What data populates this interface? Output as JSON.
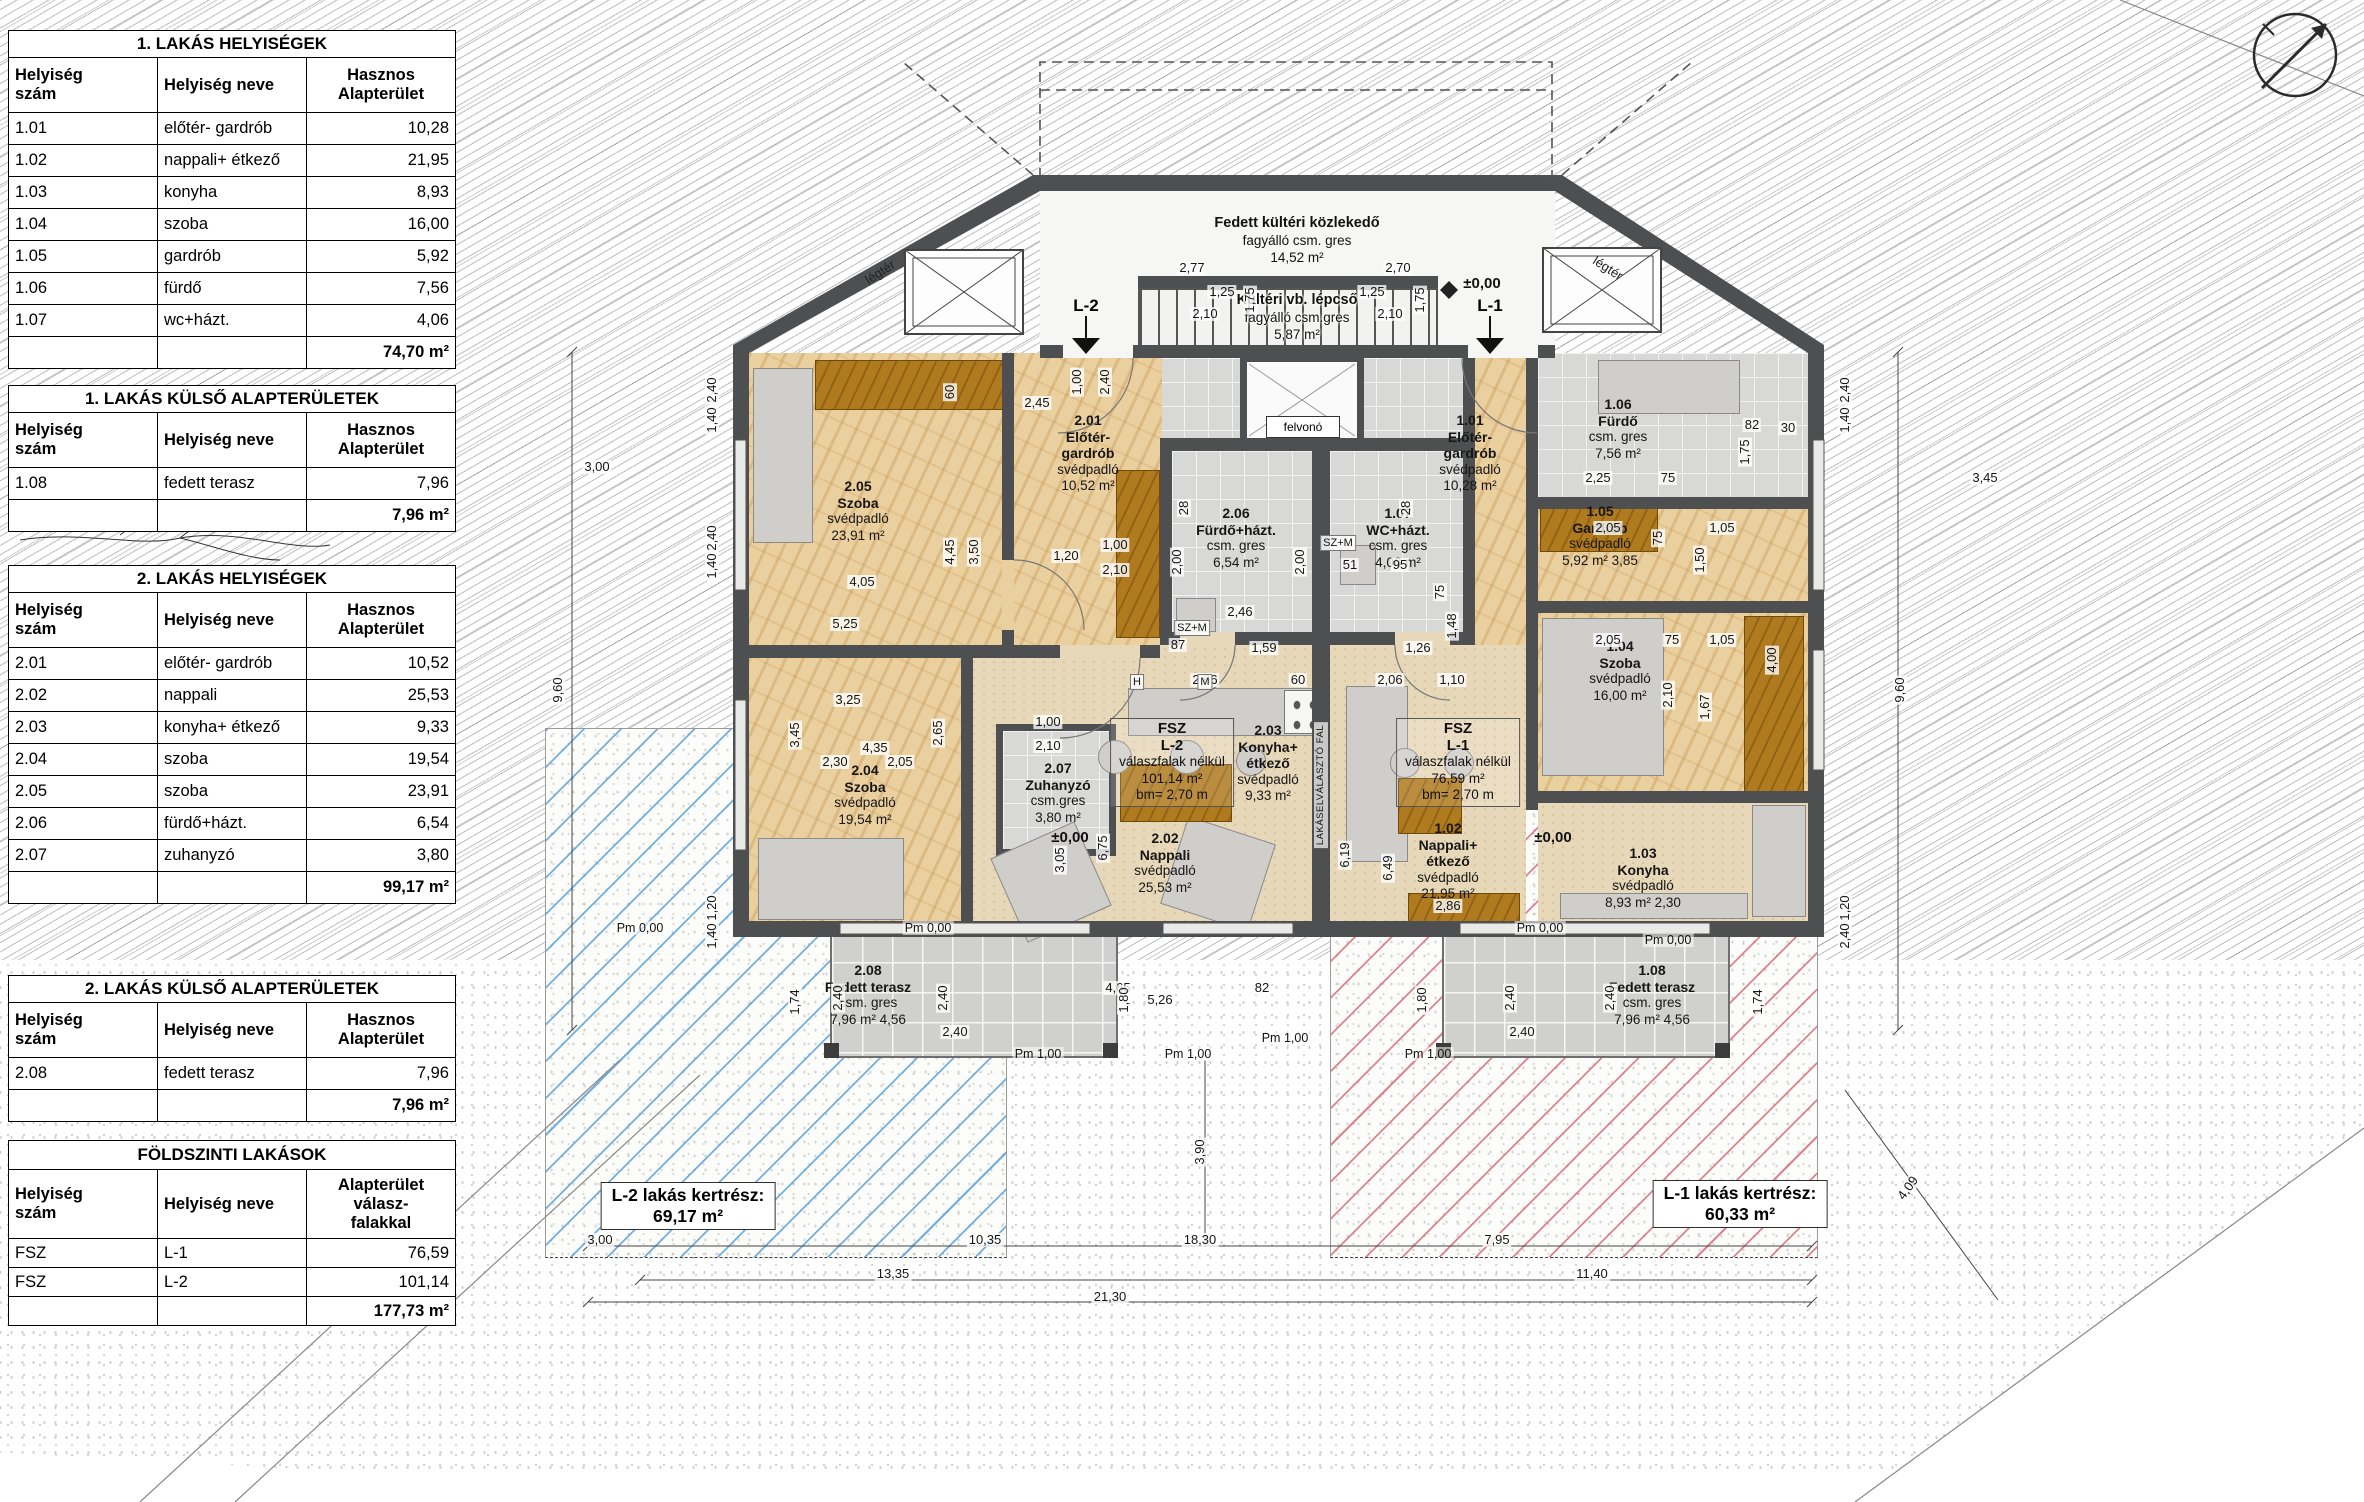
{
  "tables": [
    {
      "title": "1. LAKÁS HELYISÉGEK",
      "headers": [
        "Helyiség\nszám",
        "Helyiség neve",
        "Hasznos\nAlapterület"
      ],
      "rows": [
        [
          "1.01",
          "előtér- gardrób",
          "10,28"
        ],
        [
          "1.02",
          "nappali+ étkező",
          "21,95"
        ],
        [
          "1.03",
          "konyha",
          "8,93"
        ],
        [
          "1.04",
          "szoba",
          "16,00"
        ],
        [
          "1.05",
          "gardrób",
          "5,92"
        ],
        [
          "1.06",
          "fürdő",
          "7,56"
        ],
        [
          "1.07",
          "wc+házt.",
          "4,06"
        ]
      ],
      "total": "74,70 m²"
    },
    {
      "title": "1. LAKÁS KÜLSŐ ALAPTERÜLETEK",
      "headers": [
        "Helyiség\nszám",
        "Helyiség neve",
        "Hasznos\nAlapterület"
      ],
      "rows": [
        [
          "1.08",
          "fedett terasz",
          "7,96"
        ]
      ],
      "total": "7,96 m²"
    },
    {
      "title": "2. LAKÁS HELYISÉGEK",
      "headers": [
        "Helyiség\nszám",
        "Helyiség neve",
        "Hasznos\nAlapterület"
      ],
      "rows": [
        [
          "2.01",
          "előtér- gardrób",
          "10,52"
        ],
        [
          "2.02",
          "nappali",
          "25,53"
        ],
        [
          "2.03",
          "konyha+ étkező",
          "9,33"
        ],
        [
          "2.04",
          "szoba",
          "19,54"
        ],
        [
          "2.05",
          "szoba",
          "23,91"
        ],
        [
          "2.06",
          "fürdő+házt.",
          "6,54"
        ],
        [
          "2.07",
          "zuhanyzó",
          "3,80"
        ]
      ],
      "total": "99,17 m²"
    },
    {
      "title": "2. LAKÁS KÜLSŐ ALAPTERÜLETEK",
      "headers": [
        "Helyiség\nszám",
        "Helyiség neve",
        "Hasznos\nAlapterület"
      ],
      "rows": [
        [
          "2.08",
          "fedett terasz",
          "7,96"
        ]
      ],
      "total": "7,96 m²"
    },
    {
      "title": "FÖLDSZINTI LAKÁSOK",
      "headers": [
        "Helyiség\nszám",
        "Helyiség neve",
        "Alapterület\nválasz-\nfalakkal"
      ],
      "rows": [
        [
          "FSZ",
          "L-1",
          "76,59"
        ],
        [
          "FSZ",
          "L-2",
          "101,14"
        ]
      ],
      "total": "177,73 m²"
    }
  ],
  "plan": {
    "entrance": {
      "l1": "Fedett kültéri közlekedő",
      "l2": "fagyálló csm. gres",
      "l3": "14,52 m²"
    },
    "stair": {
      "l1": "Kültéri vb. lépcső",
      "l2": "fagyálló csm.gres",
      "l3": "5,87 m²"
    },
    "elevator": "felvonó",
    "legter": "légtér",
    "markers": [
      "L-2",
      "L-1"
    ],
    "rooms": [
      {
        "id": "2.05",
        "name": "Szoba",
        "floor": "svédpadló",
        "area": "23,91 m²",
        "cx": 858,
        "ty": 478
      },
      {
        "id": "2.01",
        "name": "Előtér-\ngardrób",
        "floor": "svédpadló",
        "area": "10,52 m²",
        "cx": 1088,
        "ty": 412
      },
      {
        "id": "2.06",
        "name": "Fürdő+házt.",
        "floor": "csm. gres",
        "area": "6,54 m²",
        "cx": 1236,
        "ty": 505
      },
      {
        "id": "1.07",
        "name": "WC+házt.",
        "floor": "csm. gres",
        "area": "4,06 m²",
        "cx": 1398,
        "ty": 505
      },
      {
        "id": "2.04",
        "name": "Szoba",
        "floor": "svédpadló",
        "area": "19,54 m²",
        "cx": 865,
        "ty": 762
      },
      {
        "id": "2.07",
        "name": "Zuhanyzó",
        "floor": "csm.gres",
        "area": "3,80 m²",
        "cx": 1058,
        "ty": 760
      },
      {
        "id": "2.03",
        "name": "Konyha+\nétkező",
        "floor": "svédpadló",
        "area": "9,33 m²",
        "cx": 1268,
        "ty": 722
      },
      {
        "id": "2.02",
        "name": "Nappali",
        "floor": "svédpadló",
        "area": "25,53 m²",
        "cx": 1165,
        "ty": 830
      },
      {
        "id": "2.08",
        "name": "Fedett terasz",
        "floor": "csm. gres",
        "area": "7,96 m²",
        "extra": "4,56",
        "cx": 868,
        "ty": 962
      },
      {
        "id": "1.01",
        "name": "Előtér-\ngardrób",
        "floor": "svédpadló",
        "area": "10,28 m²",
        "cx": 1470,
        "ty": 412
      },
      {
        "id": "1.06",
        "name": "Fürdő",
        "floor": "csm. gres",
        "area": "7,56 m²",
        "cx": 1618,
        "ty": 396
      },
      {
        "id": "1.05",
        "name": "Gardrób",
        "floor": "svédpadló",
        "area": "5,92 m²",
        "extra": "3,85",
        "cx": 1600,
        "ty": 503
      },
      {
        "id": "1.04",
        "name": "Szoba",
        "floor": "svédpadló",
        "area": "16,00 m²",
        "cx": 1620,
        "ty": 638
      },
      {
        "id": "1.02",
        "name": "Nappali+\nétkező",
        "floor": "svédpadló",
        "area": "21,95 m²",
        "cx": 1448,
        "ty": 820
      },
      {
        "id": "1.03",
        "name": "Konyha",
        "floor": "svédpadló",
        "area": "8,93 m²",
        "extra": "2,30",
        "cx": 1643,
        "ty": 845
      },
      {
        "id": "1.08",
        "name": "Fedett terasz",
        "floor": "csm. gres",
        "area": "7,96 m²",
        "extra": "4,56",
        "cx": 1652,
        "ty": 962
      }
    ],
    "fsz": [
      {
        "l1": "FSZ",
        "l2": "L-2",
        "l3": "válaszfalak nélkül",
        "l4": "101,14 m²",
        "l5": "bm= 2,70 m"
      },
      {
        "l1": "FSZ",
        "l2": "L-1",
        "l3": "válaszfalak nélkül",
        "l4": "76,59 m²",
        "l5": "bm= 2,70 m"
      }
    ],
    "gardens": [
      {
        "label": "L-2 lakás kertrész:",
        "area": "69,17 m²"
      },
      {
        "label": "L-1 lakás kertrész:",
        "area": "60,33 m²"
      }
    ],
    "dims": [
      [
        "3,00",
        600,
        1240
      ],
      [
        "10,35",
        985,
        1240
      ],
      [
        "18,30",
        1200,
        1240
      ],
      [
        "7,95",
        1497,
        1240
      ],
      [
        "13,35",
        893,
        1274
      ],
      [
        "11,40",
        1592,
        1274
      ],
      [
        "21,30",
        1110,
        1297
      ],
      [
        "9,60",
        558,
        690,
        -90
      ],
      [
        "9,60",
        1900,
        690,
        -90
      ],
      [
        "3,00",
        597,
        467
      ],
      [
        "3,45",
        1985,
        478
      ],
      [
        "4,09",
        1908,
        1188,
        -54
      ],
      [
        "3,90",
        1200,
        1152,
        -90
      ],
      [
        "2,40",
        712,
        390,
        -90
      ],
      [
        "1,40",
        712,
        420,
        -90
      ],
      [
        "2,40",
        712,
        538,
        -90
      ],
      [
        "1,40",
        712,
        566,
        -90
      ],
      [
        "1,20",
        712,
        908,
        -90
      ],
      [
        "1,40",
        712,
        936,
        -90
      ],
      [
        "2,40",
        1845,
        390,
        -90
      ],
      [
        "1,40",
        1845,
        420,
        -90
      ],
      [
        "1,20",
        1845,
        908,
        -90
      ],
      [
        "2,40",
        1845,
        936,
        -90
      ],
      [
        "4,05",
        862,
        582
      ],
      [
        "5,25",
        845,
        624
      ],
      [
        "4,45",
        950,
        552,
        -90
      ],
      [
        "3,50",
        974,
        552,
        -90
      ],
      [
        "1,20",
        1066,
        556
      ],
      [
        "2,45",
        1037,
        403
      ],
      [
        "60",
        950,
        392,
        -90
      ],
      [
        "1,00",
        1077,
        382,
        -90
      ],
      [
        "2,40",
        1105,
        382,
        -90
      ],
      [
        "1,00",
        1115,
        545
      ],
      [
        "2,10",
        1115,
        570
      ],
      [
        "2,77",
        1192,
        268
      ],
      [
        "1,25",
        1222,
        292
      ],
      [
        "2,10",
        1205,
        314
      ],
      [
        "1,75",
        1250,
        300,
        -90
      ],
      [
        "2,70",
        1398,
        268
      ],
      [
        "1,25",
        1372,
        292
      ],
      [
        "2,10",
        1390,
        314
      ],
      [
        "1,75",
        1420,
        300,
        -90
      ],
      [
        "2,00",
        1177,
        562,
        -90
      ],
      [
        "2,00",
        1300,
        562,
        -90
      ],
      [
        "28",
        1184,
        508,
        -90
      ],
      [
        "28",
        1406,
        508,
        -90
      ],
      [
        "2,46",
        1240,
        612
      ],
      [
        "1,59",
        1264,
        648
      ],
      [
        "87",
        1178,
        645
      ],
      [
        "2,66",
        1205,
        680
      ],
      [
        "60",
        1298,
        680
      ],
      [
        "51",
        1350,
        565
      ],
      [
        "95",
        1400,
        565
      ],
      [
        "75",
        1440,
        592,
        -90
      ],
      [
        "1,48",
        1452,
        626,
        -90
      ],
      [
        "1,26",
        1418,
        648
      ],
      [
        "2,06",
        1390,
        680
      ],
      [
        "1,10",
        1452,
        680
      ],
      [
        "3,25",
        848,
        700
      ],
      [
        "4,35",
        875,
        748
      ],
      [
        "2,30",
        835,
        762
      ],
      [
        "2,05",
        900,
        762
      ],
      [
        "3,45",
        795,
        735,
        -90
      ],
      [
        "2,65",
        938,
        733,
        -90
      ],
      [
        "1,00",
        1048,
        722
      ],
      [
        "2,10",
        1048,
        746
      ],
      [
        "3,05",
        1060,
        860,
        -90
      ],
      [
        "6,75",
        1103,
        848,
        -90
      ],
      [
        "5,26",
        1160,
        1000
      ],
      [
        "4,65",
        1118,
        988
      ],
      [
        "82",
        1262,
        988
      ],
      [
        "6,19",
        1345,
        855,
        -90
      ],
      [
        "6,49",
        1388,
        868,
        -90
      ],
      [
        "2,86",
        1448,
        906
      ],
      [
        "2,05",
        1608,
        640
      ],
      [
        "75",
        1672,
        640
      ],
      [
        "1,05",
        1722,
        640
      ],
      [
        "2,10",
        1668,
        695,
        -90
      ],
      [
        "1,67",
        1705,
        707,
        -90
      ],
      [
        "4,00",
        1772,
        660,
        -90
      ],
      [
        "2,05",
        1608,
        528
      ],
      [
        "75",
        1658,
        538,
        -90
      ],
      [
        "1,05",
        1722,
        528
      ],
      [
        "1,50",
        1700,
        560,
        -90
      ],
      [
        "2,25",
        1598,
        478
      ],
      [
        "75",
        1668,
        478
      ],
      [
        "1,75",
        1745,
        452,
        -90
      ],
      [
        "82",
        1752,
        425
      ],
      [
        "30",
        1788,
        428
      ],
      [
        "1,74",
        795,
        1002,
        -90
      ],
      [
        "2,40",
        838,
        998,
        -90
      ],
      [
        "2,40",
        943,
        998,
        -90
      ],
      [
        "1,80",
        1124,
        1000,
        -90
      ],
      [
        "2,40",
        955,
        1032
      ],
      [
        "1,80",
        1422,
        1000,
        -90
      ],
      [
        "2,40",
        1510,
        998,
        -90
      ],
      [
        "2,40",
        1610,
        998,
        -90
      ],
      [
        "1,74",
        1758,
        1002,
        -90
      ],
      [
        "2,40",
        1522,
        1032
      ]
    ],
    "labels": [
      [
        "±0,00",
        1482,
        284,
        "b"
      ],
      [
        "±0,00",
        1070,
        838,
        "b"
      ],
      [
        "±0,00",
        1553,
        838,
        "b"
      ],
      [
        "Pm 0,00",
        640,
        928
      ],
      [
        "Pm 0,00",
        928,
        928
      ],
      [
        "Pm 0,00",
        1540,
        928
      ],
      [
        "Pm 0,00",
        1668,
        940
      ],
      [
        "Pm 1,00",
        1038,
        1054
      ],
      [
        "Pm 1,00",
        1188,
        1054
      ],
      [
        "Pm 1,00",
        1285,
        1038
      ],
      [
        "Pm 1,00",
        1428,
        1054
      ],
      [
        "SZ+M",
        1192,
        628,
        "xs"
      ],
      [
        "SZ+M",
        1338,
        543,
        "xs"
      ],
      [
        "H",
        1137,
        682,
        "xs"
      ],
      [
        "M",
        1205,
        682,
        "xs"
      ],
      [
        "LAKÁSELVÁLASZTÓ FAL",
        1321,
        785,
        "tiny",
        -90
      ]
    ]
  }
}
